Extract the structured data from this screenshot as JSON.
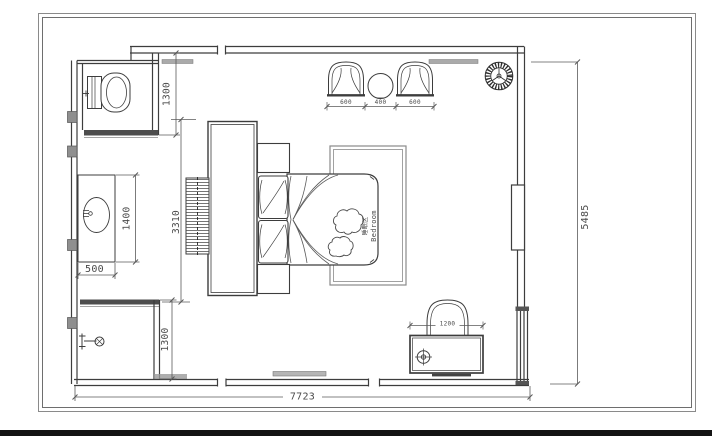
{
  "plan": {
    "zone_label_cn": "睡眠区",
    "zone_label_en": "Bedroom"
  },
  "dims": {
    "toilet_room_depth": "1300",
    "vanity_length": "1400",
    "vanity_depth": "500",
    "wardrobe_run": "3310",
    "shower_room_depth": "1300",
    "armchair_left_width": "600",
    "tea_table_width": "400",
    "armchair_right_width": "600",
    "desk_width": "1200",
    "plan_total_width": "7723",
    "plan_total_depth": "5485"
  }
}
